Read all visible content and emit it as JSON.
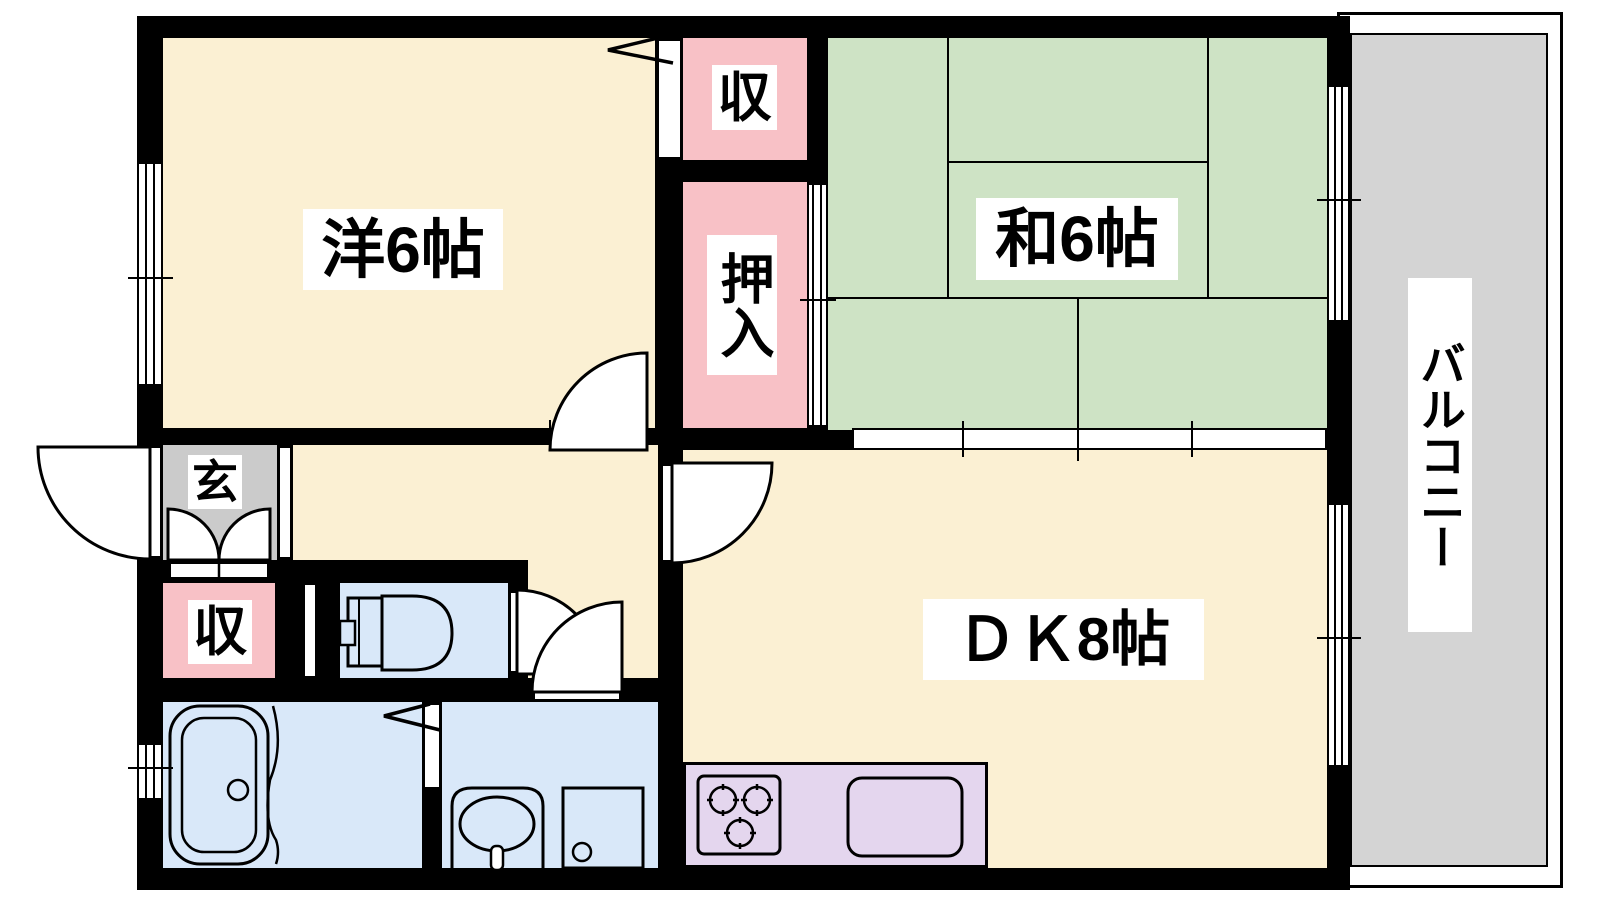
{
  "title": "apartment floor plan 2DK",
  "labels": {
    "western_room": "洋6帖",
    "japanese_room": "和6帖",
    "dining_kitchen": "ＤＫ8帖",
    "balcony": "バルコニー",
    "entrance": "玄",
    "upper_closet": "収",
    "oshiire": "押入",
    "lower_closet": "収"
  },
  "colors": {
    "room_cream": "#FBF0D3",
    "tatami_green": "#CEE3C5",
    "closet_pink": "#F8C1C6",
    "wet_area_blue": "#D9E8F9",
    "kitchen_lavender": "#E4D6EE",
    "balcony_gray": "#D4D4D4",
    "entrance_gray": "#CBCBCB",
    "wall_black": "#000000"
  }
}
